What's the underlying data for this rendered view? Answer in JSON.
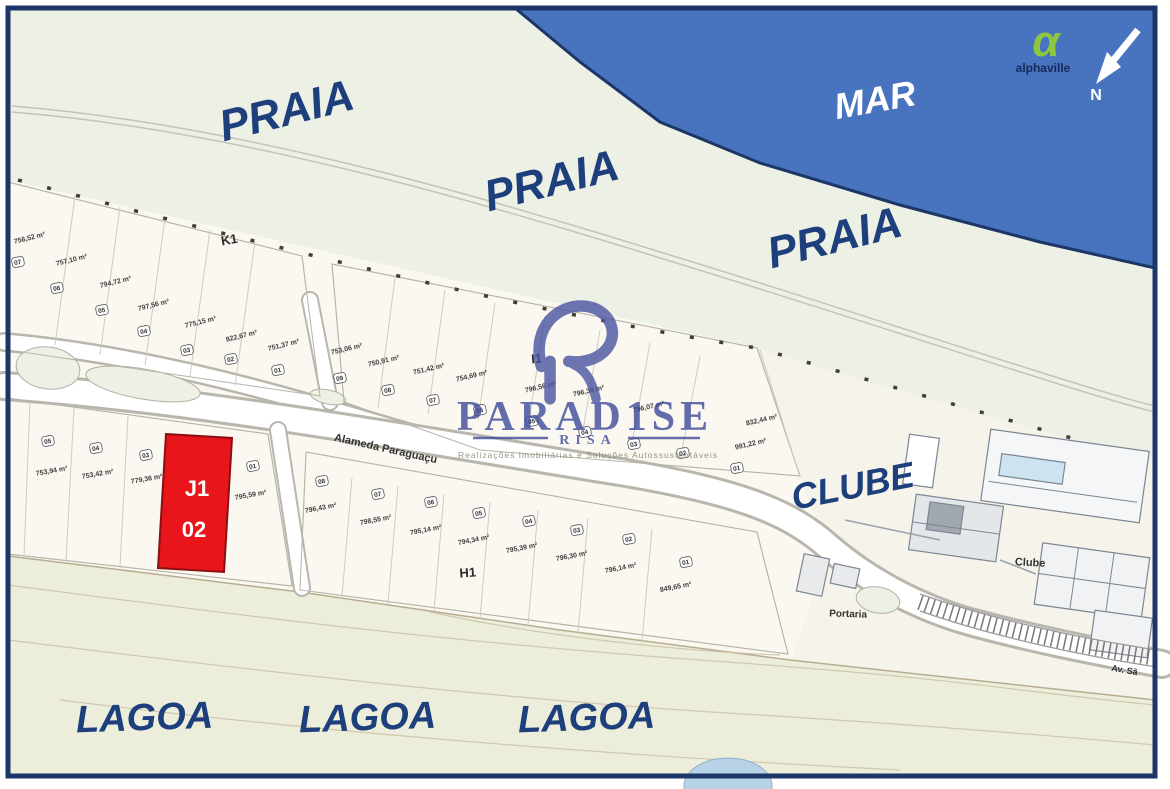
{
  "map": {
    "sea_label": "MAR",
    "beach_labels": [
      "PRAIA",
      "PRAIA",
      "PRAIA"
    ],
    "lagoon_labels": [
      "LAGOA",
      "LAGOA",
      "LAGOA"
    ],
    "club_label_large": "CLUBE",
    "club_label_small": "Clube",
    "gatehouse_label": "Portaria",
    "street_label": "Alameda Paraguaçu",
    "avenue_label": "Av. Sã",
    "north_label": "N"
  },
  "logo": {
    "brand": "alphaville",
    "alpha_glyph": "α"
  },
  "watermark": {
    "title": "PARAD1SE",
    "subtitle": "RISA",
    "tagline": "Realizações Imobiliárias e Soluções Autossustentáveis"
  },
  "highlight": {
    "block": "J1",
    "lot": "02",
    "color": "#e8151a"
  },
  "colors": {
    "sea": "#4873bf",
    "frame": "#1c3667",
    "beach": "#edf0e4",
    "lots_zone": "#faf8f0",
    "lagoon": "#eceedb",
    "label_blue": "#1d3f7c",
    "highlight_red": "#e8151a"
  },
  "lot_blocks": [
    {
      "name": "K1",
      "label": {
        "x": 230,
        "y": 244,
        "rot": -10
      },
      "area_rot": -14,
      "lots": [
        {
          "num": "07",
          "area": "756,52 m²",
          "nx": 18,
          "ny": 262,
          "ax": 30,
          "ay": 240
        },
        {
          "num": "06",
          "area": "757,10 m²",
          "nx": 57,
          "ny": 288,
          "ax": 72,
          "ay": 262
        },
        {
          "num": "05",
          "area": "794,72 m²",
          "nx": 102,
          "ny": 310,
          "ax": 116,
          "ay": 284
        },
        {
          "num": "04",
          "area": "797,56 m²",
          "nx": 144,
          "ny": 331,
          "ax": 154,
          "ay": 307
        },
        {
          "num": "03",
          "area": "775,15 m²",
          "nx": 187,
          "ny": 350,
          "ax": 201,
          "ay": 324
        },
        {
          "num": "02",
          "area": "822,67 m²",
          "nx": 231,
          "ny": 359,
          "ax": 242,
          "ay": 338
        },
        {
          "num": "01",
          "area": "751,37 m²",
          "nx": 278,
          "ny": 370,
          "ax": 284,
          "ay": 347
        }
      ]
    },
    {
      "name": "I1",
      "label": {
        "x": 537,
        "y": 363,
        "rot": -5
      },
      "area_rot": -13,
      "lots": [
        {
          "num": "09",
          "area": "753,06 m²",
          "nx": 340,
          "ny": 378,
          "ax": 347,
          "ay": 351
        },
        {
          "num": "08",
          "area": "750,91 m²",
          "nx": 388,
          "ny": 390,
          "ax": 384,
          "ay": 363
        },
        {
          "num": "07",
          "area": "751,42 m²",
          "nx": 433,
          "ny": 400,
          "ax": 429,
          "ay": 371
        },
        {
          "num": "06",
          "area": "754,69 m²",
          "nx": 480,
          "ny": 410,
          "ax": 472,
          "ay": 378
        },
        {
          "num": "05",
          "area": "796,56 m²",
          "nx": 532,
          "ny": 421,
          "ax": 541,
          "ay": 389
        },
        {
          "num": "04",
          "area": "796,34 m²",
          "nx": 585,
          "ny": 432,
          "ax": 589,
          "ay": 393
        },
        {
          "num": "03",
          "area": "796,07 m²",
          "nx": 634,
          "ny": 444,
          "ax": 649,
          "ay": 409
        },
        {
          "num": "02",
          "area": "832,44 m²",
          "nx": 683,
          "ny": 453,
          "ax": 762,
          "ay": 422
        },
        {
          "num": "01",
          "area": "991,22 m²",
          "nx": 737,
          "ny": 468,
          "ax": 751,
          "ay": 446
        }
      ]
    },
    {
      "name": "J1",
      "label": null,
      "area_rot": -10,
      "lots": [
        {
          "num": "05",
          "area": "753,94 m²",
          "nx": 48,
          "ny": 441,
          "ax": 52,
          "ay": 473
        },
        {
          "num": "04",
          "area": "753,42 m²",
          "nx": 96,
          "ny": 448,
          "ax": 98,
          "ay": 476
        },
        {
          "num": "03",
          "area": "779,36 m²",
          "nx": 146,
          "ny": 455,
          "ax": 147,
          "ay": 481
        },
        {
          "num": "01",
          "area": "795,59 m²",
          "nx": 253,
          "ny": 466,
          "ax": 251,
          "ay": 497
        }
      ]
    },
    {
      "name": "H1",
      "label": {
        "x": 468,
        "y": 577,
        "rot": -4
      },
      "area_rot": -11,
      "lots": [
        {
          "num": "08",
          "area": "796,43 m²",
          "nx": 322,
          "ny": 481,
          "ax": 321,
          "ay": 510
        },
        {
          "num": "07",
          "area": "798,55 m²",
          "nx": 378,
          "ny": 494,
          "ax": 376,
          "ay": 522
        },
        {
          "num": "06",
          "area": "795,14 m²",
          "nx": 431,
          "ny": 502,
          "ax": 426,
          "ay": 532
        },
        {
          "num": "05",
          "area": "794,34 m²",
          "nx": 479,
          "ny": 513,
          "ax": 474,
          "ay": 542
        },
        {
          "num": "04",
          "area": "795,39 m²",
          "nx": 529,
          "ny": 521,
          "ax": 522,
          "ay": 550
        },
        {
          "num": "03",
          "area": "796,30 m²",
          "nx": 577,
          "ny": 530,
          "ax": 572,
          "ay": 558
        },
        {
          "num": "02",
          "area": "796,14 m²",
          "nx": 629,
          "ny": 539,
          "ax": 621,
          "ay": 570
        },
        {
          "num": "01",
          "area": "849,65 m²",
          "nx": 686,
          "ny": 562,
          "ax": 676,
          "ay": 589
        }
      ]
    }
  ]
}
